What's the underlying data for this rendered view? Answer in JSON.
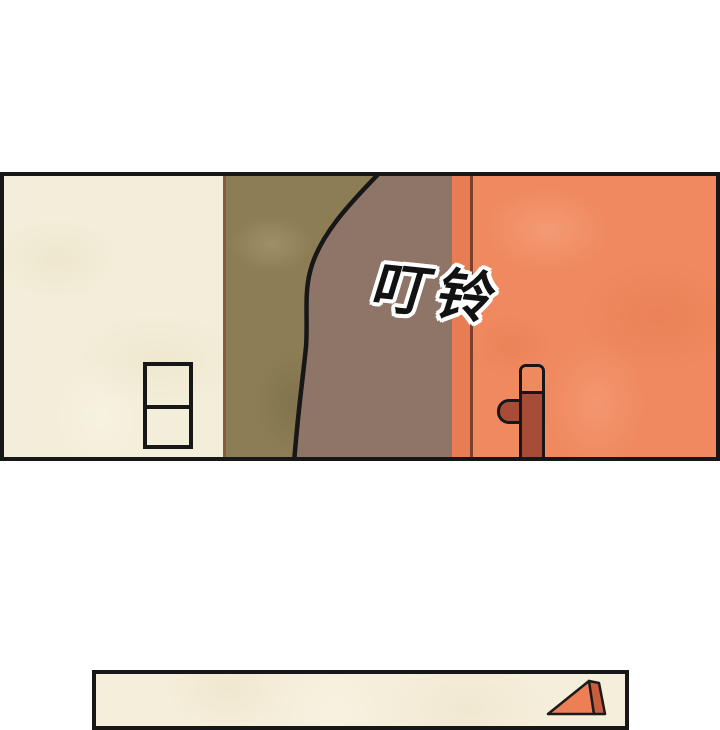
{
  "page": {
    "width": 720,
    "height": 700,
    "background": "#ffffff"
  },
  "panel_top": {
    "sfx_text": "叮铃",
    "colors": {
      "border": "#171717",
      "wall_cream": "#f3eed9",
      "wall_divider": "#8a5a3c",
      "wall_olive": "#8c7d55",
      "figure_brown": "#8f7568",
      "figure_outline": "#171717",
      "door_edge": "#e87d53",
      "door_frame_line": "#7d4030",
      "door_main": "#f0895f",
      "handle_dark": "#a84c38",
      "handle_top": "#ef8a5f",
      "sfx_fill": "#121212"
    }
  },
  "panel_bottom": {
    "colors": {
      "border": "#171717",
      "wall_cream": "#f5eeda",
      "box_front": "#ec7f55",
      "box_side": "#c85e3f",
      "box_outline": "#1b1b1b"
    }
  }
}
